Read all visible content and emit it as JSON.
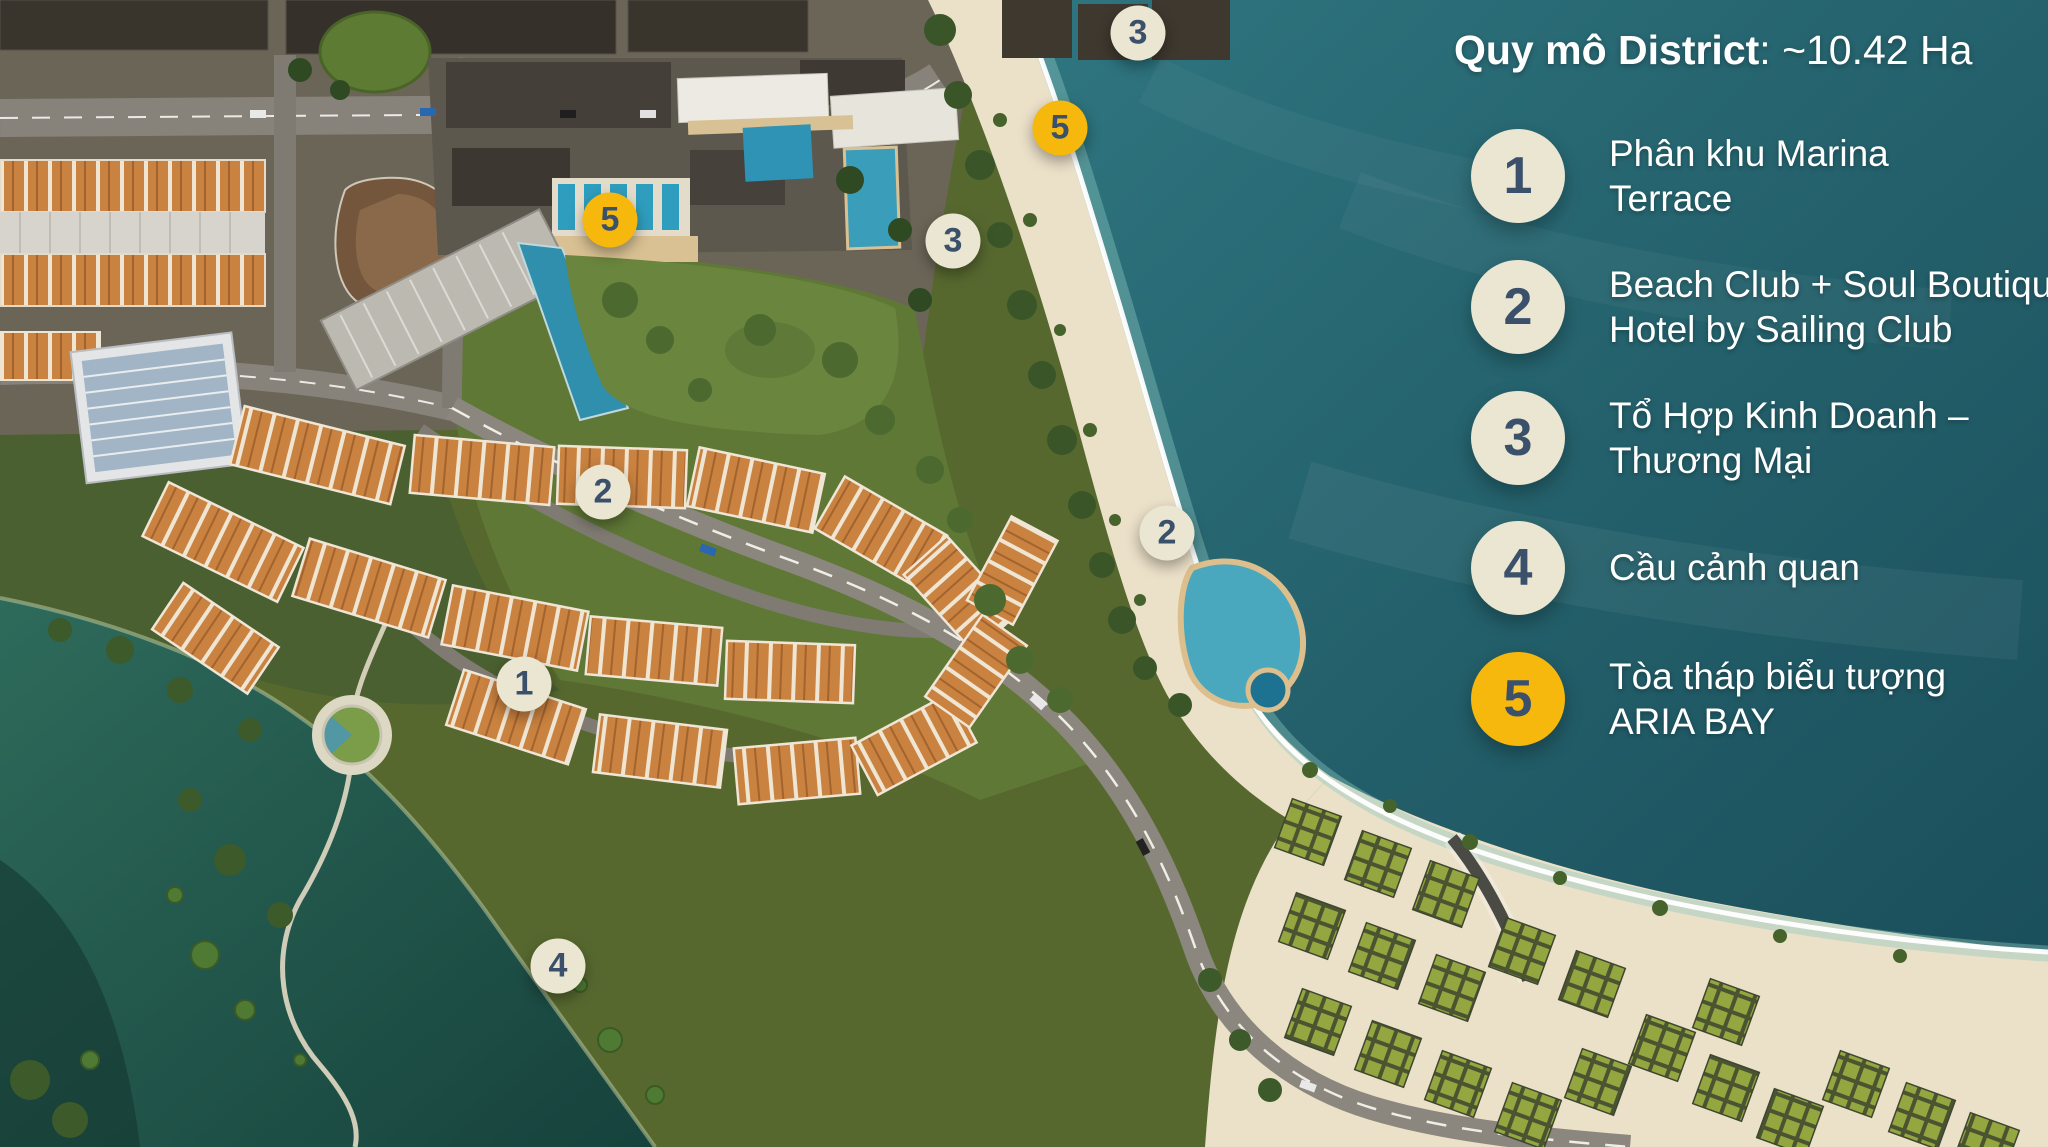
{
  "legend": {
    "title_bold": "Quy mô District",
    "title_rest": ": ~10.42 Ha",
    "items": [
      {
        "num": "1",
        "variant": "cream",
        "lines": [
          "Phân khu Marina",
          "Terrace"
        ]
      },
      {
        "num": "2",
        "variant": "cream",
        "lines": [
          "Beach Club + Soul Boutique",
          "Hotel by Sailing Club"
        ]
      },
      {
        "num": "3",
        "variant": "cream",
        "lines": [
          "Tổ Hợp Kinh Doanh –",
          "Thương Mại"
        ]
      },
      {
        "num": "4",
        "variant": "cream",
        "lines": [
          "Cầu cảnh quan"
        ]
      },
      {
        "num": "5",
        "variant": "gold",
        "lines": [
          "Tòa tháp biểu tượng",
          "ARIA BAY"
        ]
      }
    ]
  },
  "map_markers": [
    {
      "num": "3",
      "x": 1138,
      "y": 33,
      "variant": "cream"
    },
    {
      "num": "5",
      "x": 1060,
      "y": 128,
      "variant": "gold"
    },
    {
      "num": "3",
      "x": 953,
      "y": 241,
      "variant": "cream"
    },
    {
      "num": "5",
      "x": 610,
      "y": 220,
      "variant": "gold"
    },
    {
      "num": "2",
      "x": 603,
      "y": 492,
      "variant": "cream"
    },
    {
      "num": "2",
      "x": 1167,
      "y": 533,
      "variant": "cream"
    },
    {
      "num": "1",
      "x": 524,
      "y": 684,
      "variant": "cream"
    },
    {
      "num": "4",
      "x": 558,
      "y": 966,
      "variant": "cream"
    }
  ],
  "colors": {
    "marker-cream": "#EAE6D2",
    "marker-gold": "#F7B80D",
    "marker-number": "#3A506B",
    "legend-text": "#FFFFFF"
  }
}
